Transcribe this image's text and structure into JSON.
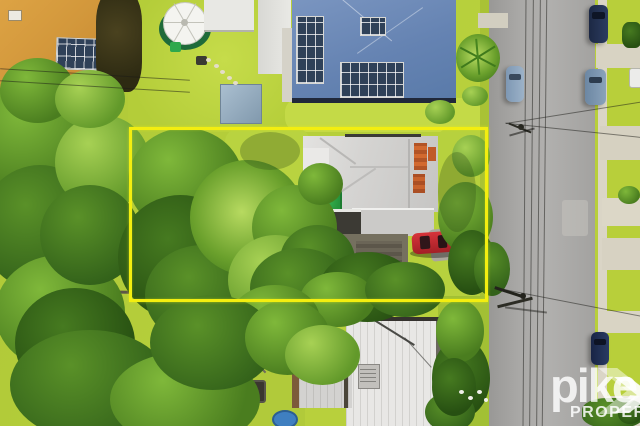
{
  "watermark": {
    "brand": "pike",
    "tagline": "PROPERTY"
  },
  "colors": {
    "boundary_highlight": "#f3ee10",
    "watermark_text": "#ffffff",
    "road": "#a5a4a2",
    "grass": "#b5ce3c",
    "subject_roof": "#d3d2d0",
    "red_car": "#c1272d"
  }
}
